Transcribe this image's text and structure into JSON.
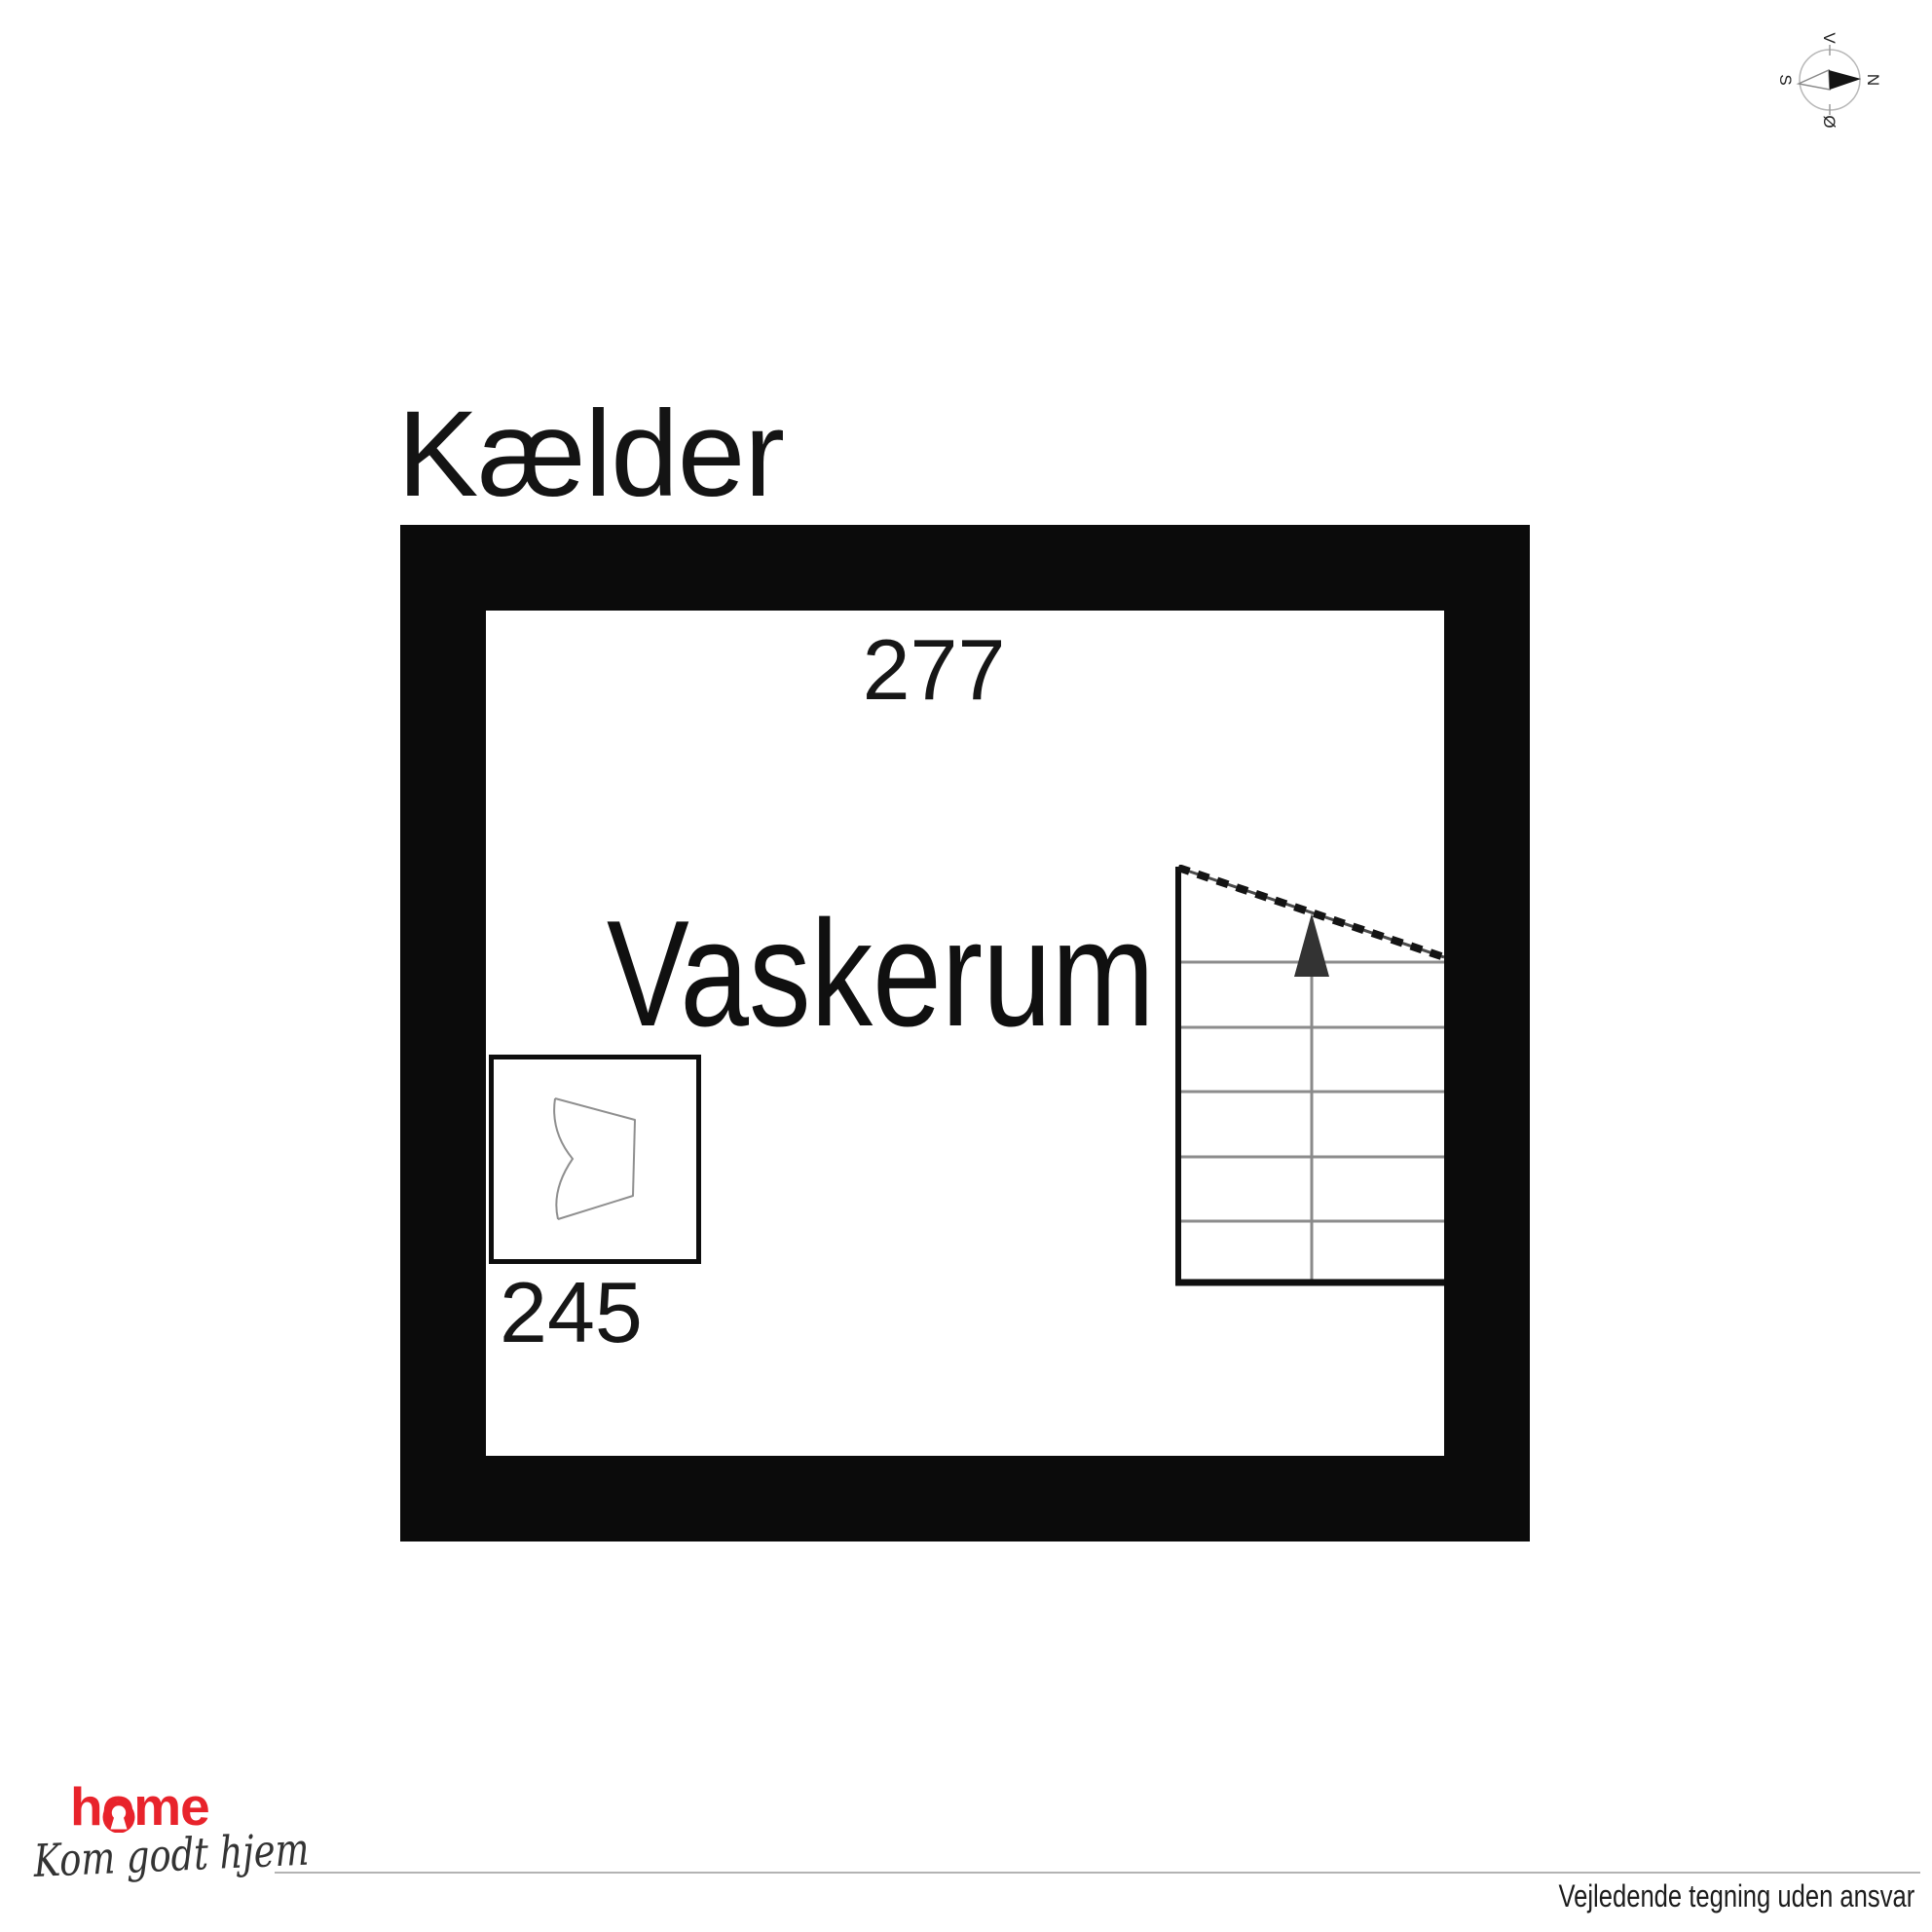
{
  "title": "Kælder",
  "plan": {
    "room_label": "Vaskerum",
    "dim_top": "277",
    "dim_left": "245"
  },
  "compass": {
    "n": "N",
    "s": "S",
    "v": "V",
    "oe": "Ø"
  },
  "footer": {
    "brand": "home",
    "tagline": "Kom godt hjem",
    "disclaimer": "Vejledende tegning uden ansvar"
  },
  "colors": {
    "wall": "#0b0b0b",
    "brand_red": "#e8232b",
    "step_line": "#8c8c8c",
    "symbol_line": "#8f8f8f",
    "rule_gray": "#b3b3b3"
  }
}
